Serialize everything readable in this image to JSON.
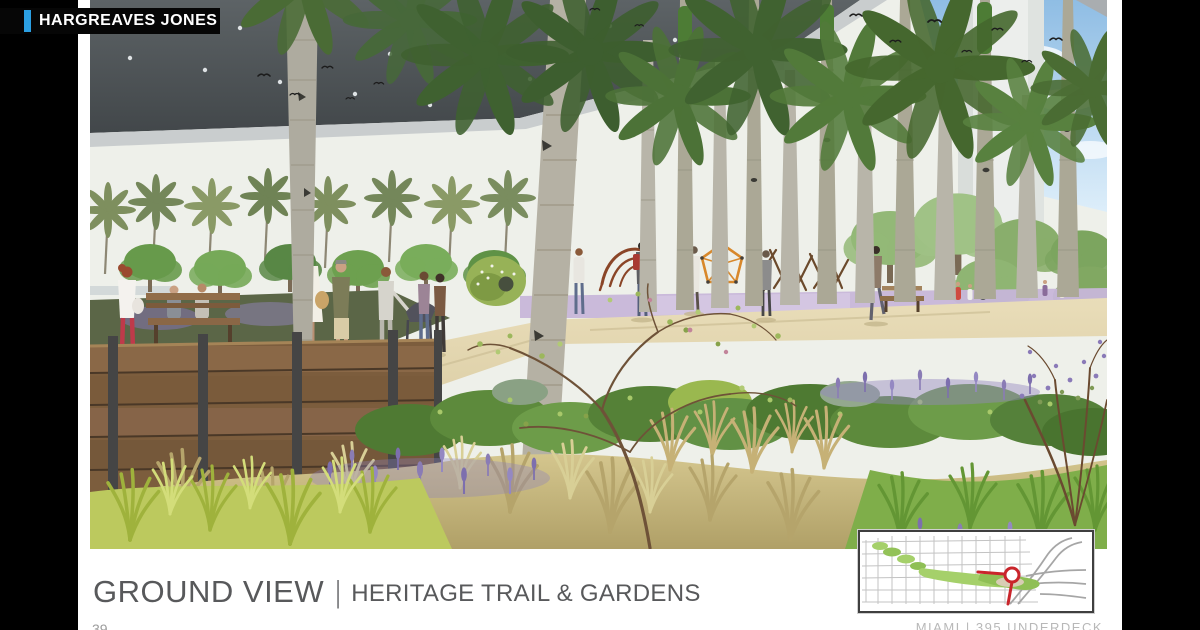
{
  "brand": {
    "name": "HARGREAVES JONES",
    "accent_blue": "#2b9fe3",
    "box_bg": "#060606",
    "text_color": "#ffffff"
  },
  "caption": {
    "title": "GROUND VIEW",
    "separator": "|",
    "subtitle": "HERITAGE TRAIL & GARDENS",
    "color": "#58595b"
  },
  "footer": {
    "page_number": "39",
    "project_label": "MIAMI | 395 UNDERDECK"
  },
  "map_inset": {
    "border_color": "#3f3f3f",
    "street_color": "#c3c3c3",
    "highway_color": "#a6a6a6",
    "park_color": "#a5d06a",
    "marker_color": "#c9252b"
  },
  "scene": {
    "alt": "Architectural rendering, ground-level view of the Heritage Trail and Gardens beneath the elevated I-395 highway deck: a grove of palm trunks rising into the dark soffit with recessed lights, a sandy walking trail with pedestrians, a stroller and a small dog, timber benches and a wood retaining wall, native meadow grasses with lavender drifts, a purple play surface with an orange geodesic climber and wooden stick sculptures, white bridge piers and blue sky with birds to the right",
    "palette": {
      "deck_soffit": "#50565a",
      "deck_fascia": "#c9cdce",
      "sky_blue": "#a9cdea",
      "path_sand": "#e0d4ac",
      "meadow_gold": "#c4b279",
      "shrub_green": "#5d8a3c",
      "lavender": "#8a7cbb",
      "playground_purple": "#c6b5d8",
      "timber": "#826240"
    }
  }
}
